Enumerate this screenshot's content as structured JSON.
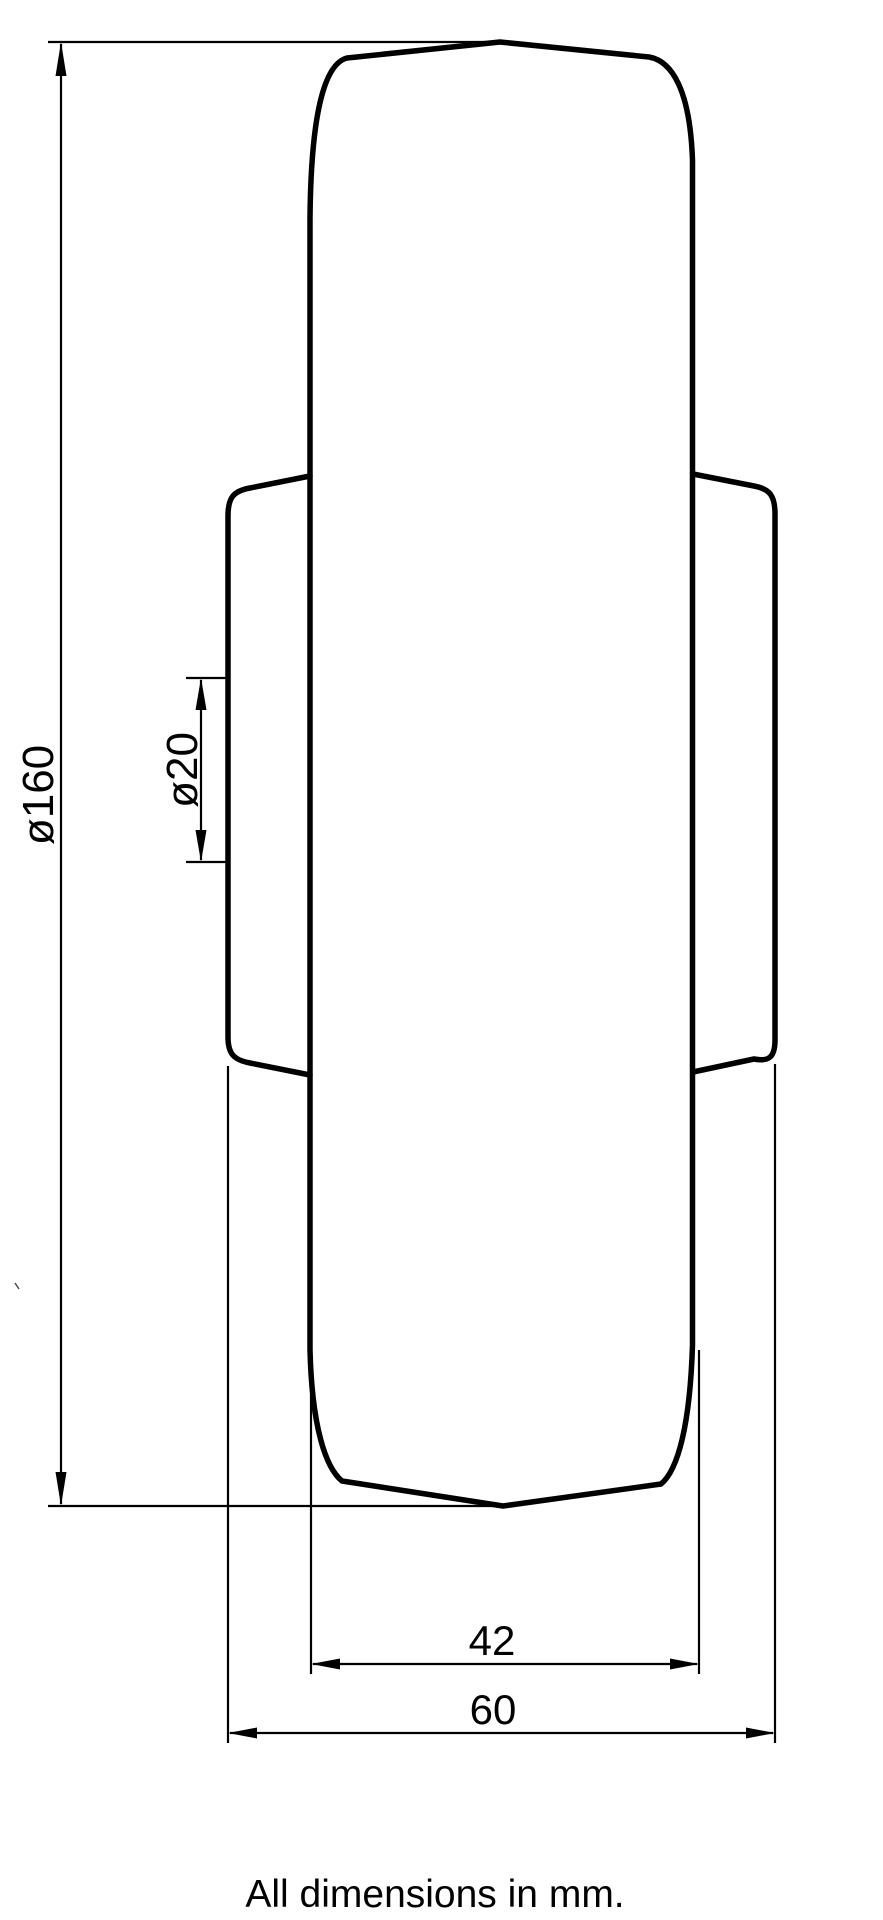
{
  "drawing": {
    "type": "technical-dimension-drawing",
    "subject": "wheel-side-profile",
    "units": "mm",
    "footer_note": "All dimensions in mm.",
    "colors": {
      "line": "#000000",
      "background": "#ffffff"
    },
    "dimensions": [
      {
        "id": "wheel-diameter",
        "label": "ø160",
        "value": 160,
        "kind": "diameter",
        "orientation": "vertical"
      },
      {
        "id": "bore-diameter",
        "label": "ø20",
        "value": 20,
        "kind": "diameter",
        "orientation": "vertical"
      },
      {
        "id": "tread-width",
        "label": "42",
        "value": 42,
        "kind": "linear",
        "orientation": "horizontal"
      },
      {
        "id": "hub-width",
        "label": "60",
        "value": 60,
        "kind": "linear",
        "orientation": "horizontal"
      }
    ]
  }
}
